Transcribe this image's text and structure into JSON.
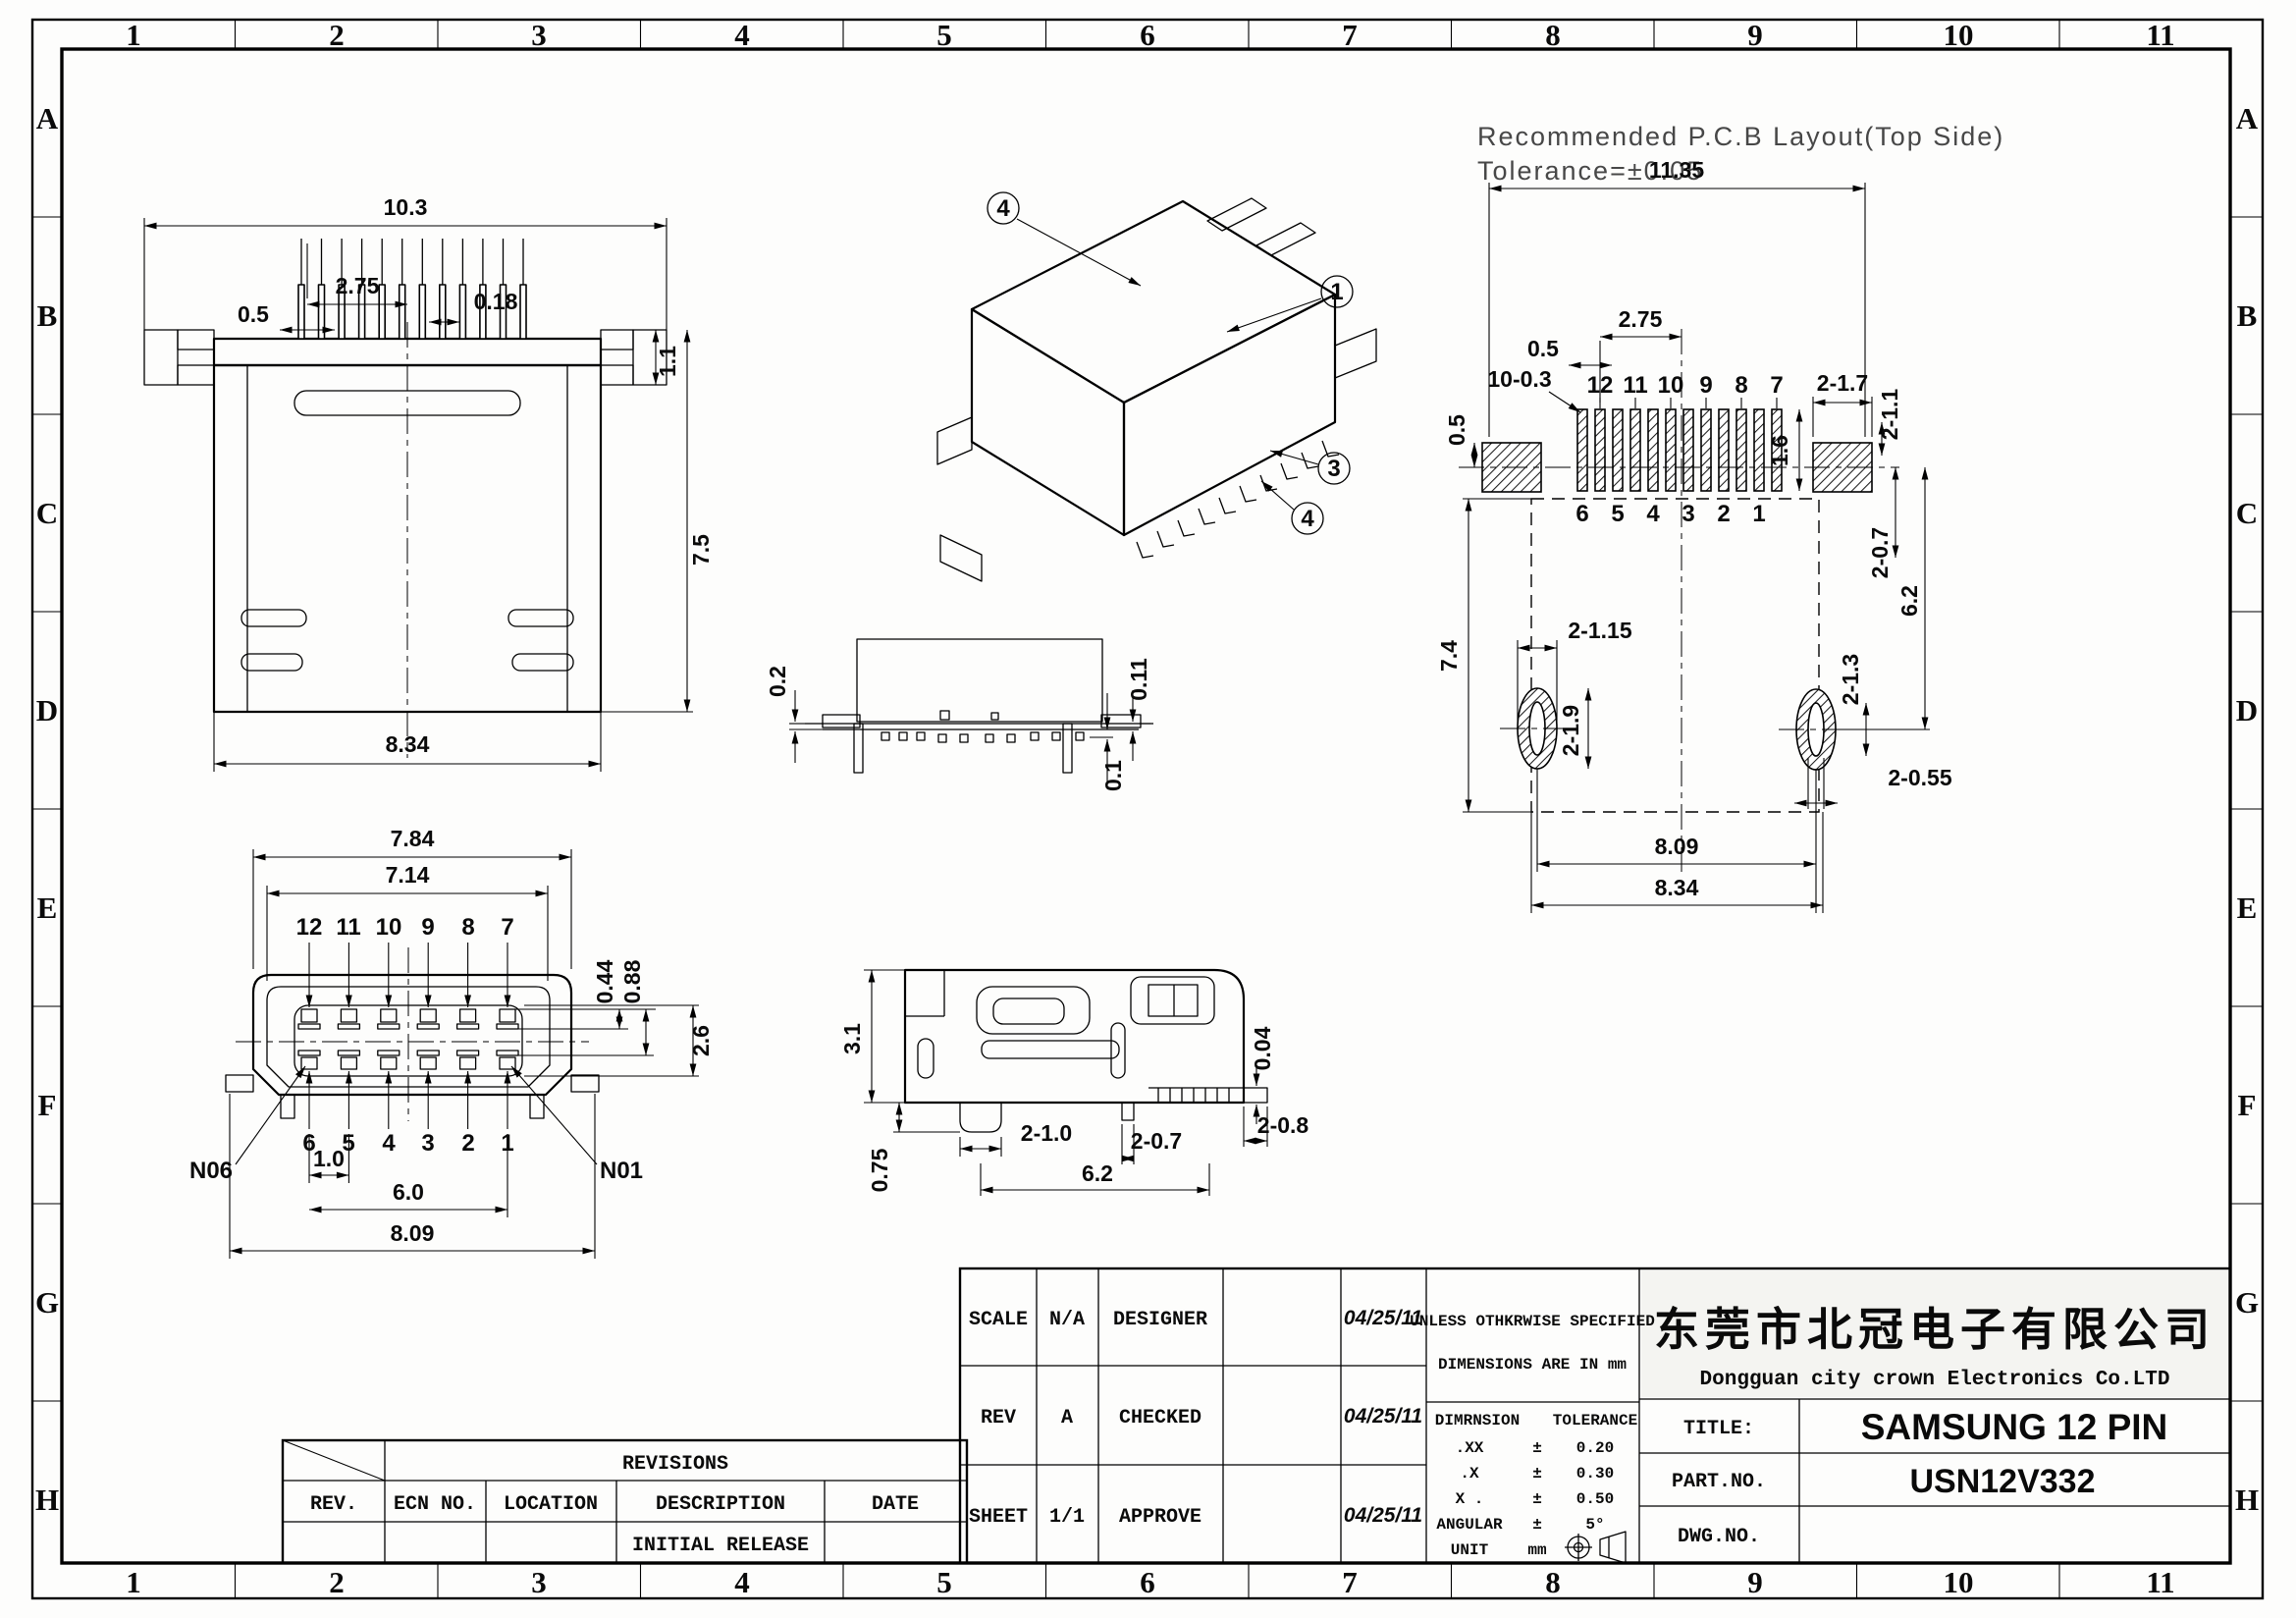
{
  "sheet": {
    "grid_cols": [
      "1",
      "2",
      "3",
      "4",
      "5",
      "6",
      "7",
      "8",
      "9",
      "10",
      "11"
    ],
    "grid_rows": [
      "A",
      "B",
      "C",
      "D",
      "E",
      "F",
      "G",
      "H"
    ],
    "line_color": "#000000",
    "background": "#fdfdfc"
  },
  "top_view": {
    "dims": {
      "overall": "10.3",
      "pitch": "2.75",
      "pin_width": "0.5",
      "pin_tip": "0.18",
      "flange": "1.1",
      "height": "7.5",
      "body_width": "8.34"
    }
  },
  "iso_view": {
    "callouts": [
      "4",
      "1",
      "3",
      "4"
    ]
  },
  "pcb_layout": {
    "title": "Recommended P.C.B Layout(Top Side)",
    "tolerance_note": "Tolerance=±0.05",
    "pins_top": [
      "12",
      "11",
      "10",
      "9",
      "8",
      "7"
    ],
    "pins_bottom": [
      "6",
      "5",
      "4",
      "3",
      "2",
      "1"
    ],
    "dims": {
      "overall": "11.35",
      "pitch": "2.75",
      "pad_width": "0.5",
      "pads": "10-0.3",
      "side_pad": "2-1.7",
      "side_pad_height": "2-1.1",
      "pad_length": "1.6",
      "edge_offset": "0.5",
      "body_depth": "7.4",
      "hole_offset": "2-0.7",
      "hole_span": "6.2",
      "slot_width": "2-1.15",
      "slot_height": "2-1.9",
      "hole_height": "2-1.3",
      "hole_width": "2-0.55",
      "hole_pitch": "8.09",
      "body_width": "8.34"
    }
  },
  "front_view": {
    "pins_top": [
      "12",
      "11",
      "10",
      "9",
      "8",
      "7"
    ],
    "pins_bottom": [
      "6",
      "5",
      "4",
      "3",
      "2",
      "1"
    ],
    "labels": {
      "left": "N06",
      "right": "N01"
    },
    "dims": {
      "outer": "7.84",
      "inner": "7.14",
      "pad_offset": "0.44",
      "pad_pitch": "0.88",
      "height": "2.6",
      "pin_pitch": "1.0",
      "row_span": "6.0",
      "foot_span": "8.09"
    }
  },
  "profile_view": {
    "dims": {
      "standoff": "0.2",
      "pad_thickness": "0.11",
      "coplanarity": "0.1"
    }
  },
  "side_view": {
    "dims": {
      "height": "3.1",
      "foot": "0.75",
      "leg": "2-1.0",
      "tab": "2-0.7",
      "tail": "2-0.8",
      "span": "6.2",
      "clearance": "0.04"
    }
  },
  "revisions": {
    "title": "REVISIONS",
    "columns": [
      "REV.",
      "ECN NO.",
      "LOCATION",
      "DESCRIPTION",
      "DATE"
    ],
    "rows": [
      {
        "rev": "",
        "ecn": "",
        "location": "",
        "description": "INITIAL RELEASE",
        "date": ""
      }
    ]
  },
  "title_block": {
    "scale_label": "SCALE",
    "scale_value": "N/A",
    "rev_label": "REV",
    "rev_value": "A",
    "sheet_label": "SHEET",
    "sheet_value": "1/1",
    "designer_label": "DESIGNER",
    "checked_label": "CHECKED",
    "approve_label": "APPROVE",
    "date_designer": "04/25/11",
    "date_checked": "04/25/11",
    "date_approve": "04/25/11",
    "note_line1": "UNLESS OTHKRWISE SPECIFIED",
    "note_line2": "DIMENSIONS ARE IN mm",
    "tol_dim_header": "DIMRNSION",
    "tol_tol_header": "TOLERANCE",
    "tol_rows": [
      {
        "dim": ".XX",
        "pm": "±",
        "tol": "0.20"
      },
      {
        "dim": ".X",
        "pm": "±",
        "tol": "0.30"
      },
      {
        "dim": "X .",
        "pm": "±",
        "tol": "0.50"
      },
      {
        "dim": "ANGULAR",
        "pm": "±",
        "tol": "5°"
      }
    ],
    "unit_label": "UNIT",
    "unit_value": "mm",
    "company_cn": "东莞市北冠电子有限公司",
    "company_en": "Dongguan city crown Electronics Co.LTD",
    "title_label": "TITLE:",
    "title_value": "SAMSUNG 12 PIN",
    "part_label": "PART.NO.",
    "part_value": "USN12V332",
    "dwg_label": "DWG.NO.",
    "dwg_value": ""
  }
}
